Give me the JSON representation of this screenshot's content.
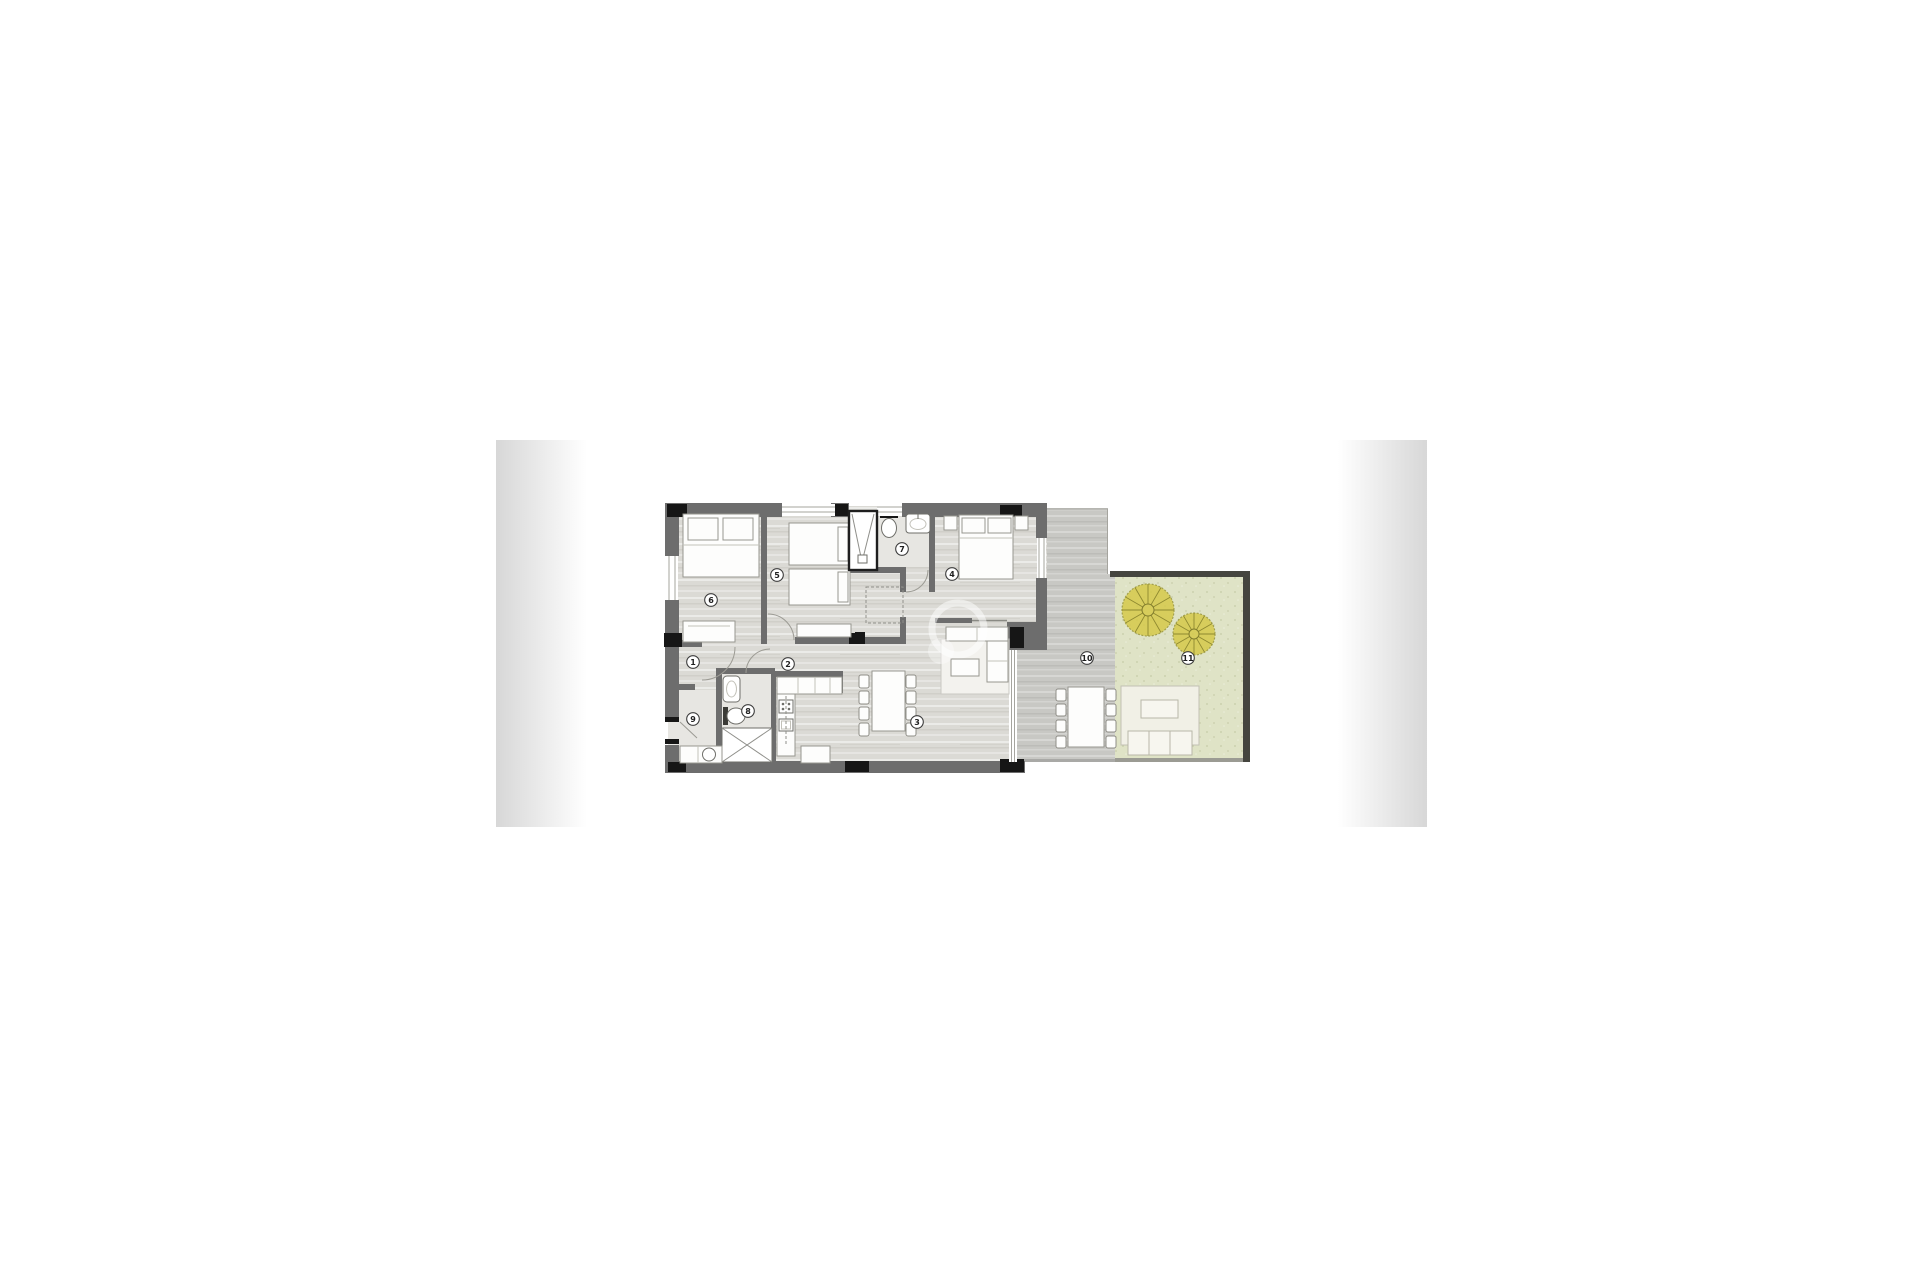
{
  "image": {
    "type": "apartment floor plan",
    "room_labels": [
      {
        "text": "1"
      },
      {
        "text": "2"
      },
      {
        "text": "3"
      },
      {
        "text": "4"
      },
      {
        "text": "5"
      },
      {
        "text": "6"
      },
      {
        "text": "7"
      },
      {
        "text": "8"
      },
      {
        "text": "9"
      },
      {
        "text": "10"
      },
      {
        "text": "11"
      }
    ],
    "colors": {
      "background": "#ffffff",
      "wall": "#6d6d6d",
      "column": "#161616",
      "floor": "#dbdad5",
      "floor_light": "#e7e6e2",
      "terrace": "#c8c8c4",
      "garden": "#dfe3c6",
      "garden_wall": "#45453f",
      "tree": "#d6ca4a",
      "furniture": "#fdfdfc",
      "edge_fade": "#d7d7d7"
    }
  }
}
